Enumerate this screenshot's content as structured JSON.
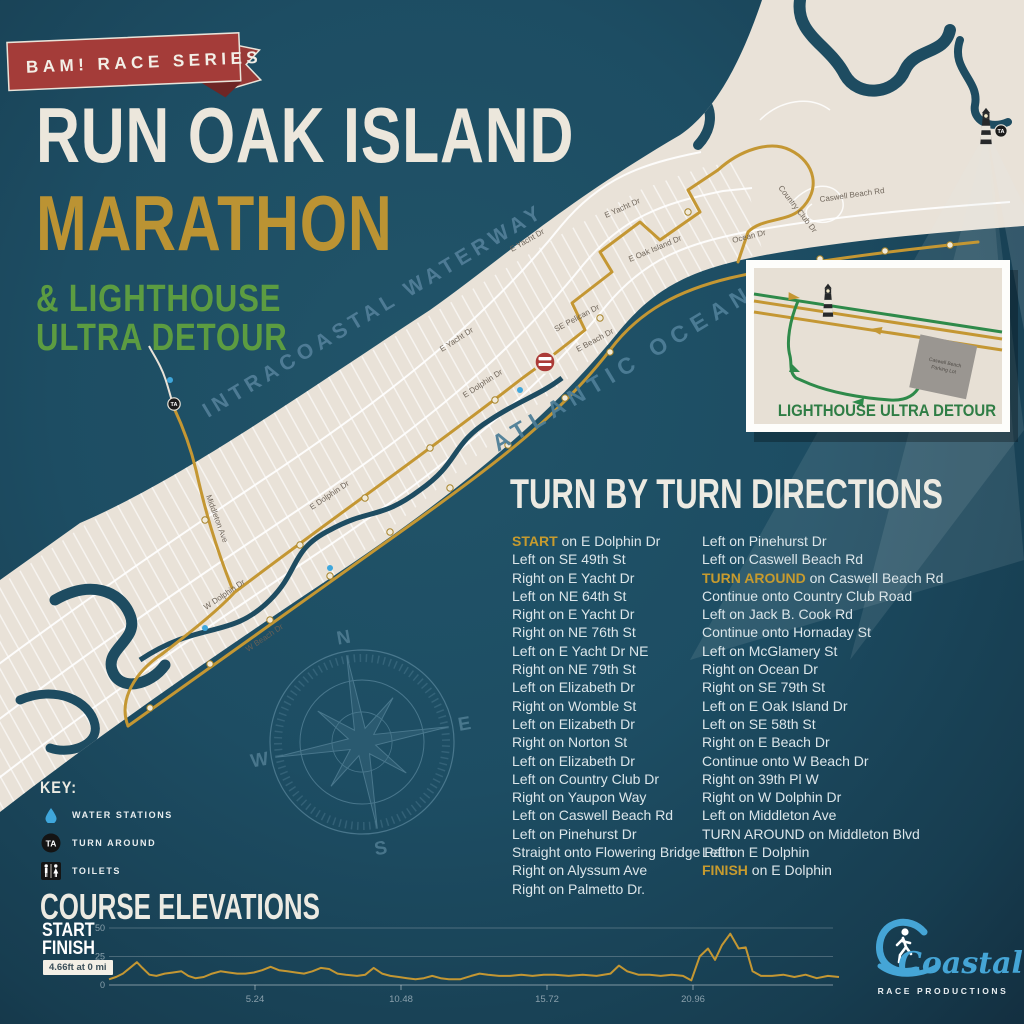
{
  "banner": {
    "label": "BAM! RACE SERIES"
  },
  "title": {
    "line1": "RUN OAK ISLAND",
    "line2": "MARATHON",
    "line3a": "& LIGHTHOUSE",
    "line3b": "ULTRA DETOUR"
  },
  "map": {
    "waterway_label": "INTRACOASTAL WATERWAY",
    "ocean_label": "ATLANTIC OCEAN",
    "street_labels": [
      {
        "text": "E Dolphin Dr"
      },
      {
        "text": "E Dolphin Dr"
      },
      {
        "text": "W Dolphin Dr"
      },
      {
        "text": "W Beach Dr"
      },
      {
        "text": "E Beach Dr"
      },
      {
        "text": "SE Pelican Dr"
      },
      {
        "text": "E Yacht Dr"
      },
      {
        "text": "E Yacht Dr"
      },
      {
        "text": "E Yacht Dr"
      },
      {
        "text": "E Oak Island Dr"
      },
      {
        "text": "Middleton Ave"
      },
      {
        "text": "Caswell Beach Rd"
      },
      {
        "text": "Country Club Dr"
      },
      {
        "text": "Ocean Dr"
      }
    ],
    "markers": {
      "start_finish": "start-finish-badge",
      "turn_around": "TA",
      "lighthouse": "lighthouse"
    },
    "compass": {
      "n": "N",
      "e": "E",
      "s": "S",
      "w": "W"
    },
    "inset": {
      "label": "LIGHTHOUSE ULTRA DETOUR",
      "parking_line1": "Caswell Beach",
      "parking_line2": "Parking Lot"
    }
  },
  "directions": {
    "heading": "TURN BY TURN DIRECTIONS",
    "col1": [
      {
        "hl": "START",
        "rest": " on E Dolphin Dr"
      },
      {
        "hl": "",
        "rest": "Left on SE 49th St"
      },
      {
        "hl": "",
        "rest": "Right on E Yacht Dr"
      },
      {
        "hl": "",
        "rest": "Left on NE 64th St"
      },
      {
        "hl": "",
        "rest": "Right on E Yacht Dr"
      },
      {
        "hl": "",
        "rest": "Right on NE 76th St"
      },
      {
        "hl": "",
        "rest": "Left on E Yacht Dr NE"
      },
      {
        "hl": "",
        "rest": "Right on NE 79th St"
      },
      {
        "hl": "",
        "rest": "Left on Elizabeth Dr"
      },
      {
        "hl": "",
        "rest": "Right on Womble St"
      },
      {
        "hl": "",
        "rest": "Left on Elizabeth Dr"
      },
      {
        "hl": "",
        "rest": "Right on Norton St"
      },
      {
        "hl": "",
        "rest": "Left on Elizabeth Dr"
      },
      {
        "hl": "",
        "rest": "Left on Country Club Dr"
      },
      {
        "hl": "",
        "rest": "Right on Yaupon Way"
      },
      {
        "hl": "",
        "rest": "Left on Caswell Beach Rd"
      },
      {
        "hl": "",
        "rest": "Left on Pinehurst Dr"
      },
      {
        "hl": "",
        "rest": "Straight onto Flowering Bridge Path"
      },
      {
        "hl": "",
        "rest": "Right on Alyssum Ave"
      },
      {
        "hl": "",
        "rest": "Right on Palmetto Dr."
      }
    ],
    "col2": [
      {
        "hl": "",
        "rest": "Left on Pinehurst Dr"
      },
      {
        "hl": "",
        "rest": "Left on Caswell Beach Rd"
      },
      {
        "hl": "TURN AROUND",
        "rest": " on Caswell Beach Rd"
      },
      {
        "hl": "",
        "rest": "Continue onto Country Club Road"
      },
      {
        "hl": "",
        "rest": "Left on Jack B. Cook Rd"
      },
      {
        "hl": "",
        "rest": "Continue onto Hornaday St"
      },
      {
        "hl": "",
        "rest": "Left on McGlamery St"
      },
      {
        "hl": "",
        "rest": "Right on Ocean Dr"
      },
      {
        "hl": "",
        "rest": "Right on SE 79th St"
      },
      {
        "hl": "",
        "rest": "Left on E Oak Island Dr"
      },
      {
        "hl": "",
        "rest": "Left on SE 58th St"
      },
      {
        "hl": "",
        "rest": "Right on E Beach Dr"
      },
      {
        "hl": "",
        "rest": "Continue onto W Beach Dr"
      },
      {
        "hl": "",
        "rest": "Right on 39th Pl W"
      },
      {
        "hl": "",
        "rest": "Right on W Dolphin Dr"
      },
      {
        "hl": "",
        "rest": "Left on Middleton Ave"
      },
      {
        "hl": "",
        "rest": "TURN AROUND on Middleton Blvd"
      },
      {
        "hl": "",
        "rest": "Left on E Dolphin"
      },
      {
        "hl": "FINISH",
        "rest": " on E Dolphin"
      }
    ]
  },
  "key": {
    "heading": "KEY:",
    "items": [
      {
        "icon": "water-droplet-icon",
        "label": "WATER STATIONS"
      },
      {
        "icon": "turn-around-icon",
        "label": "TURN AROUND"
      },
      {
        "icon": "toilets-icon",
        "label": "TOILETS"
      }
    ],
    "ta_text": "TA"
  },
  "elevation": {
    "heading": "COURSE ELEVATIONS",
    "start_label": "START",
    "finish_label": "FINISH",
    "badge": "4.66ft at 0 mi"
  },
  "chart_data": {
    "type": "line",
    "title": "COURSE ELEVATIONS",
    "xlabel": "miles",
    "ylabel": "elevation (ft)",
    "xlim": [
      0,
      26.4
    ],
    "ylim": [
      0,
      50
    ],
    "x_ticks": [
      5.24,
      10.48,
      15.72,
      20.96
    ],
    "y_ticks": [
      0,
      25,
      50
    ],
    "start_annotation": "4.66ft at 0 mi",
    "series": [
      {
        "name": "elevation_ft",
        "points": [
          [
            0,
            5
          ],
          [
            0.25,
            7
          ],
          [
            0.5,
            10
          ],
          [
            0.8,
            16
          ],
          [
            1.0,
            20
          ],
          [
            1.2,
            15
          ],
          [
            1.45,
            9
          ],
          [
            1.7,
            8
          ],
          [
            2.0,
            10
          ],
          [
            2.3,
            11
          ],
          [
            2.6,
            12
          ],
          [
            2.85,
            8
          ],
          [
            3.1,
            6
          ],
          [
            3.4,
            7
          ],
          [
            3.7,
            10
          ],
          [
            4.0,
            12
          ],
          [
            4.3,
            11
          ],
          [
            4.6,
            10
          ],
          [
            4.9,
            10
          ],
          [
            5.2,
            11
          ],
          [
            5.5,
            13
          ],
          [
            5.8,
            16
          ],
          [
            6.1,
            13
          ],
          [
            6.4,
            12
          ],
          [
            6.7,
            11
          ],
          [
            7.0,
            10
          ],
          [
            7.3,
            12
          ],
          [
            7.6,
            15
          ],
          [
            7.9,
            14
          ],
          [
            8.2,
            10
          ],
          [
            8.5,
            9
          ],
          [
            8.9,
            8
          ],
          [
            9.2,
            9
          ],
          [
            9.5,
            15
          ],
          [
            9.8,
            10
          ],
          [
            10.1,
            8
          ],
          [
            10.4,
            7
          ],
          [
            10.7,
            6
          ],
          [
            11.0,
            5
          ],
          [
            11.3,
            6
          ],
          [
            11.6,
            8
          ],
          [
            11.9,
            6
          ],
          [
            12.2,
            5
          ],
          [
            12.6,
            5
          ],
          [
            13.0,
            8
          ],
          [
            13.3,
            10
          ],
          [
            13.6,
            9
          ],
          [
            14.0,
            8
          ],
          [
            14.4,
            8
          ],
          [
            14.8,
            9
          ],
          [
            15.2,
            8
          ],
          [
            15.6,
            9
          ],
          [
            16.0,
            9
          ],
          [
            16.5,
            8
          ],
          [
            17.0,
            9
          ],
          [
            17.5,
            8
          ],
          [
            18.0,
            10
          ],
          [
            18.3,
            17
          ],
          [
            18.6,
            12
          ],
          [
            19.0,
            9
          ],
          [
            19.4,
            9
          ],
          [
            19.8,
            8
          ],
          [
            20.2,
            9
          ],
          [
            20.6,
            8
          ],
          [
            20.9,
            4
          ],
          [
            21.2,
            25
          ],
          [
            21.5,
            32
          ],
          [
            21.75,
            22
          ],
          [
            22.0,
            35
          ],
          [
            22.3,
            45
          ],
          [
            22.6,
            32
          ],
          [
            22.85,
            33
          ],
          [
            23.1,
            12
          ],
          [
            23.4,
            8
          ],
          [
            23.8,
            8
          ],
          [
            24.2,
            9
          ],
          [
            24.6,
            7
          ],
          [
            25.0,
            9
          ],
          [
            25.4,
            6
          ],
          [
            25.8,
            8
          ],
          [
            26.2,
            7
          ]
        ]
      }
    ]
  },
  "logo": {
    "name": "Coastal",
    "subtitle": "RACE PRODUCTIONS"
  },
  "colors": {
    "background": "#1d4d63",
    "island": "#e9e2d8",
    "route_gold": "#c49733",
    "detour_green": "#2e8a4a",
    "banner_red": "#a43c39",
    "title_cream": "#ece7dc",
    "title_gold": "#bb9333",
    "title_green": "#5c9c41",
    "ocean_label_blue": "#4e7e97",
    "logo_blue": "#45a5d6"
  }
}
